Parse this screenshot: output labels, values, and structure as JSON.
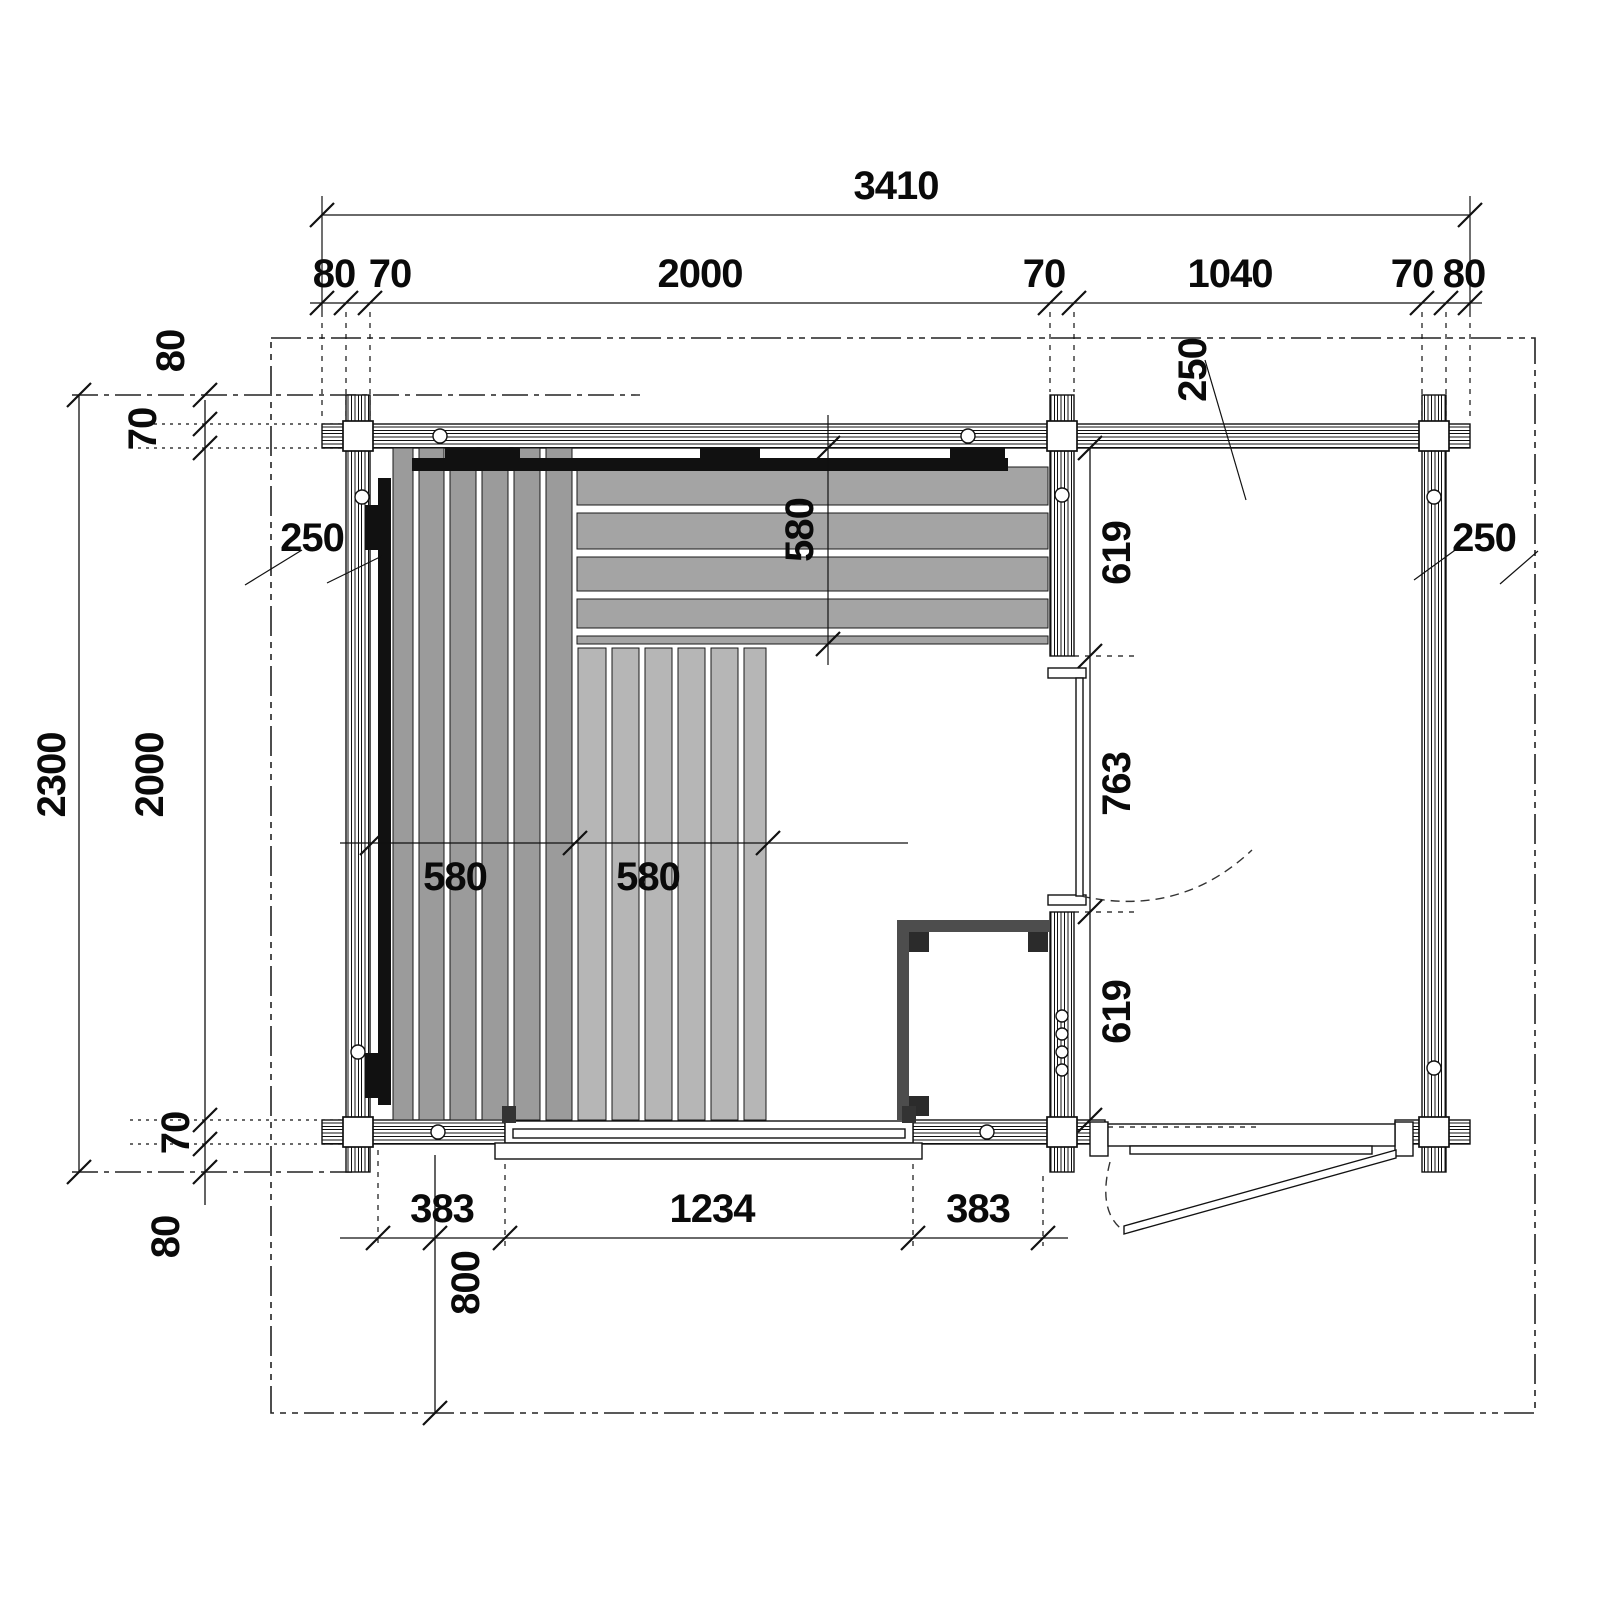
{
  "dimensions": {
    "overall_width": "3410",
    "top_chain": [
      "80",
      "70",
      "2000",
      "70",
      "1040",
      "70",
      "80"
    ],
    "overall_depth": "2300",
    "interior_depth": "2000",
    "top_left_log_end": "80",
    "top_left_wall": "70",
    "bottom_left_wall": "70",
    "bottom_left_log_end": "80",
    "roof_overhang_left": "250",
    "roof_overhang_top": "250",
    "roof_overhang_right": "250",
    "upper_bench_depth": "580",
    "left_bench_width": "580",
    "lower_bench_width": "580",
    "partition_chain": [
      "619",
      "763",
      "619"
    ],
    "bottom_chain": [
      "383",
      "1234",
      "383"
    ],
    "porch_depth": "800"
  },
  "colors": {
    "line": "#111111",
    "bench_dark": "#9b9b9b",
    "bench_mid": "#a4a4a4",
    "bench_light": "#b6b6b6",
    "backrest": "#111111",
    "heater_wall": "#4d4d4d",
    "heater_corner": "#2b2b2b"
  }
}
